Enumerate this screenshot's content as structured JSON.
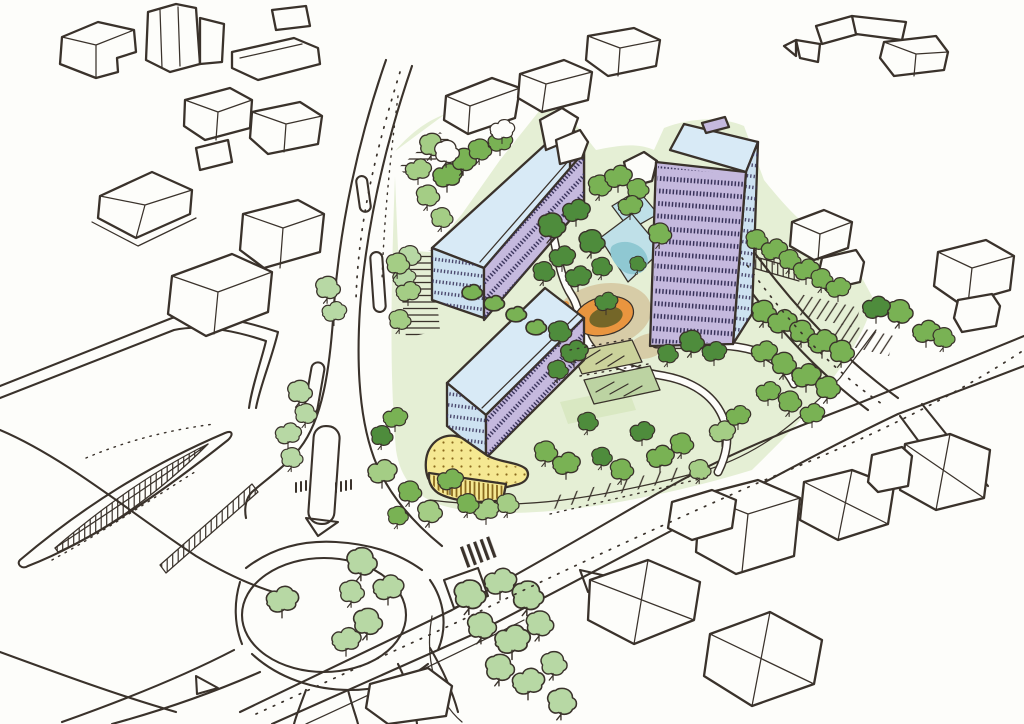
{
  "palette": {
    "paper": "#fdfdfa",
    "ink": "#3a322b",
    "window_ink": "#38325a",
    "slab_lavender": "#c5b9de",
    "roof_blue": "#d8eaf6",
    "glass_blue": "#cde2f1",
    "podium_yellow": "#f5e892",
    "podium_accent": "#8a6a1e",
    "pool_light": "#bfe0e8",
    "pool_deep": "#8fc8d2",
    "orange": "#e9953f",
    "orange_core": "#746628",
    "tree_dark": "#4e8c3c",
    "tree_mid": "#79b254",
    "tree_light": "#a4cd85",
    "tree_pale": "#b7d8a4",
    "ground": "#e5efd5",
    "lawn": "#d9e8c2",
    "plot_khaki": "#cbd29b",
    "plot_green": "#bcd3a2",
    "tan": "#d7cca7"
  },
  "elements": {
    "development": [
      "slab-block-north",
      "slab-block-south",
      "tower-block",
      "yellow-podium",
      "courtyard-pool",
      "orange-play-circle",
      "garden-plots",
      "park-trees"
    ],
    "context": [
      "existing-buildings",
      "detached-houses",
      "boulevard",
      "arterial-road",
      "roundabout",
      "station-canopy",
      "parking-bays",
      "street-trees",
      "traffic-islands",
      "zebra-crossing"
    ]
  }
}
